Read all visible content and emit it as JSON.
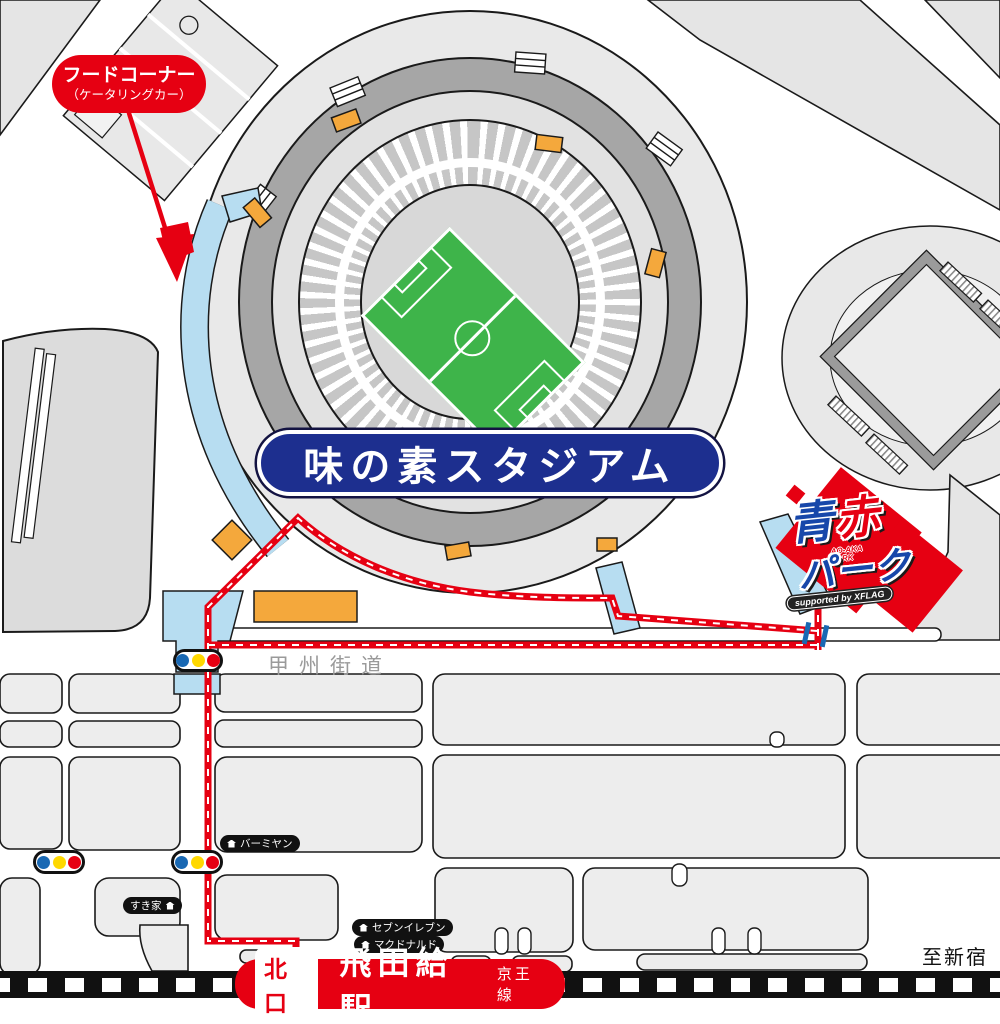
{
  "stadium": {
    "name": "味の素スタジアム"
  },
  "food_corner": {
    "line1": "フードコーナー",
    "line2": "（ケータリングカー）"
  },
  "park_logo": {
    "ao": "青",
    "aka": "赤",
    "park": "パーク",
    "latin_line1": "AO-AKA",
    "latin_line2": "PARK",
    "supported_by": "supported by XFLAG"
  },
  "roads": {
    "koshu_kaido": "甲州街道"
  },
  "shops": {
    "bamiyan": "バーミヤン",
    "sukiya": "すき家",
    "seven_eleven": "セブンイレブン",
    "mcdonalds": "マクドナルド"
  },
  "station": {
    "exit": "北口",
    "name": "飛田給駅",
    "line": "京王線"
  },
  "directions": {
    "to_shinjuku": "至新宿"
  },
  "colors": {
    "route_red": "#e60012",
    "banner_navy": "#1d2f8f",
    "walkway_blue": "#b7ddf1",
    "field_green": "#3eb44a",
    "gate_orange": "#f4a83c",
    "signal_blue": "#1968b3",
    "signal_yellow": "#ffd800",
    "signal_red": "#e60012"
  }
}
